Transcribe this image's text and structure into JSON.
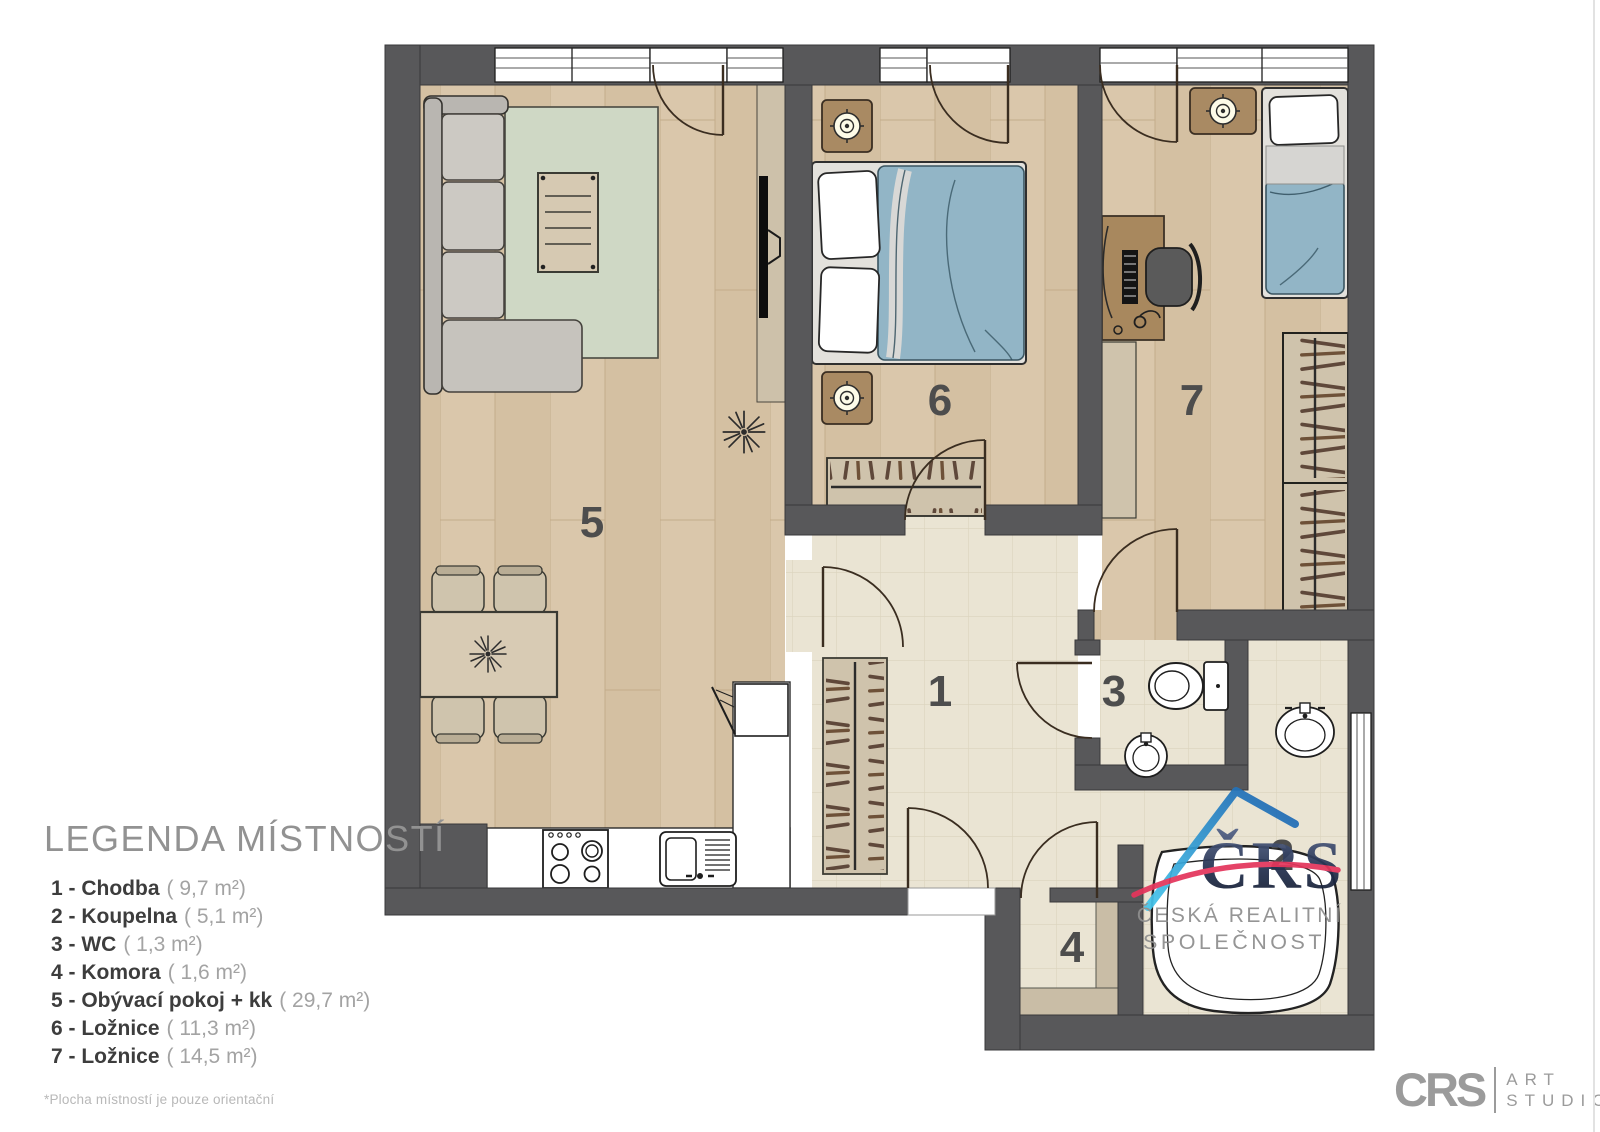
{
  "legend": {
    "title": "LEGENDA MÍSTNOSTÍ",
    "items": [
      {
        "label": "1 - Chodba",
        "area": "( 9,7 m²)"
      },
      {
        "label": "2 - Koupelna",
        "area": "( 5,1 m²)"
      },
      {
        "label": "3 - WC",
        "area": "( 1,3 m²)"
      },
      {
        "label": "4 - Komora",
        "area": "( 1,6 m²)"
      },
      {
        "label": "5 - Obývací pokoj + kk",
        "area": "( 29,7 m²)"
      },
      {
        "label": "6 - Ložnice",
        "area": "( 11,3 m²)"
      },
      {
        "label": "7 - Ložnice",
        "area": "( 14,5 m²)"
      }
    ],
    "footnote": "*Plocha místností je pouze orientační"
  },
  "rooms": [
    {
      "num": "1",
      "name": "Chodba"
    },
    {
      "num": "2",
      "name": "Koupelna"
    },
    {
      "num": "3",
      "name": "WC"
    },
    {
      "num": "4",
      "name": "Komora"
    },
    {
      "num": "5",
      "name": "Obývací pokoj + kk"
    },
    {
      "num": "6",
      "name": "Ložnice"
    },
    {
      "num": "7",
      "name": "Ložnice"
    }
  ],
  "watermark": {
    "brand": "ČRS",
    "line1": "ČESKÁ REALITNÍ",
    "line2": "SPOLEČNOST"
  },
  "studio": {
    "brand": "CRS",
    "line1": "ART",
    "line2": "STUDIO"
  },
  "colors": {
    "wall": "#58585a",
    "wood": "#dac7ab",
    "tile": "#eae4d3",
    "blanket_blue": "#92b5c6",
    "logo_navy": "#1d2a45",
    "logo_red": "#e4355c",
    "logo_cyan": "#45c6ec",
    "logo_blue": "#1b5fae"
  }
}
